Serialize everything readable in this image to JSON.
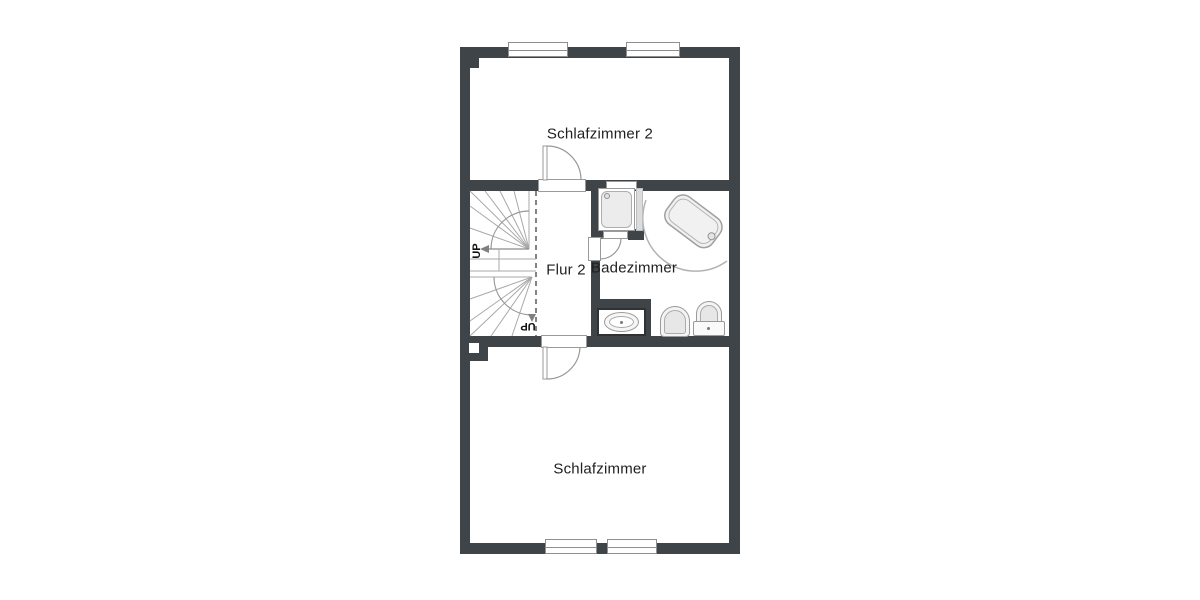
{
  "labels": {
    "bedroom2": "Schlafzimmer 2",
    "hallway": "Flur 2",
    "bathroom": "Badezimmer",
    "bedroom": "Schlafzimmer",
    "stairs_up_upper": "UP",
    "stairs_up_lower": "UP"
  },
  "rooms": [
    {
      "id": "bedroom2",
      "label": "Schlafzimmer 2",
      "windows": 2,
      "doors": 1
    },
    {
      "id": "hallway",
      "label": "Flur 2",
      "features": [
        "winder-staircase",
        "dashed-stair-line",
        "doors-to-both-bedrooms"
      ]
    },
    {
      "id": "bathroom",
      "label": "Badezimmer",
      "fixtures": [
        "shower",
        "bathtub",
        "sink",
        "bidet",
        "toilet-with-cistern"
      ]
    },
    {
      "id": "bedroom",
      "label": "Schlafzimmer",
      "windows": 2,
      "doors": 1
    }
  ],
  "stairs": {
    "direction_labels": [
      "UP",
      "UP"
    ]
  },
  "colors": {
    "wall": "#3f4448",
    "fixture_line": "#9a9a9a",
    "fixture_fill": "#ececec",
    "text": "#1f1f1f",
    "background": "#ffffff"
  }
}
